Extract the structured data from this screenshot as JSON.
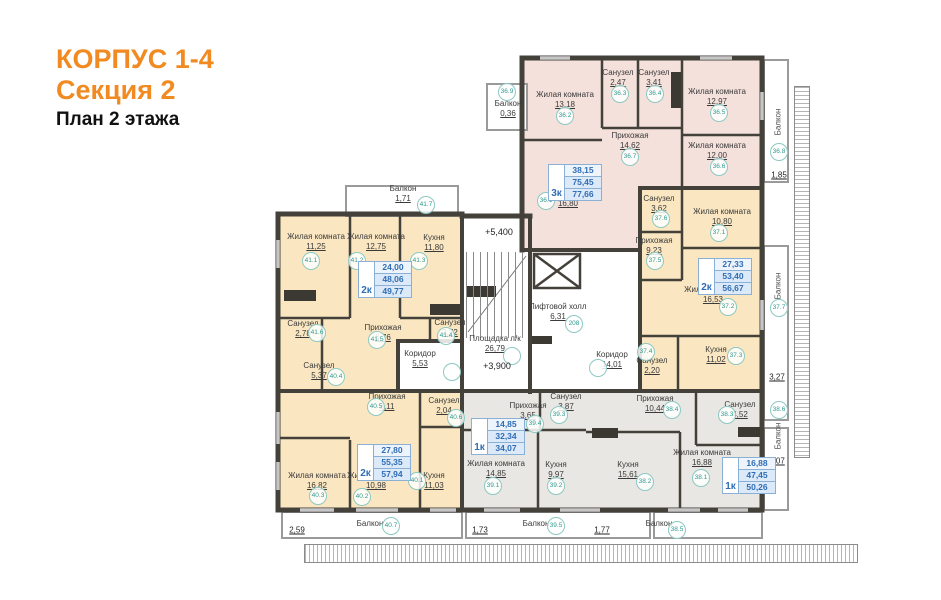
{
  "title": {
    "building": "КОРПУС 1-4",
    "section": "Секция 2",
    "plan": "План 2 этажа"
  },
  "colors": {
    "accent": "#f08a21",
    "apartment_pink": "#f5e1dc",
    "apartment_yellow": "#fae7c1",
    "apartment_gray": "#e9e7e3",
    "wall": "#44403a",
    "circle_teal": "#2e9a90",
    "value_blue": "#2f6db5"
  },
  "apartments": [
    {
      "type": "3к",
      "values": [
        "38,15",
        "75,45",
        "77,66"
      ],
      "x": 548,
      "y": 164
    },
    {
      "type": "2к",
      "values": [
        "27,33",
        "53,40",
        "56,67"
      ],
      "x": 698,
      "y": 258
    },
    {
      "type": "1к",
      "values": [
        "16,88",
        "47,45",
        "50,26"
      ],
      "x": 722,
      "y": 457
    },
    {
      "type": "1к",
      "values": [
        "14,85",
        "32,34",
        "34,07"
      ],
      "x": 471,
      "y": 418
    },
    {
      "type": "2к",
      "values": [
        "24,00",
        "48,06",
        "49,77"
      ],
      "x": 358,
      "y": 261
    },
    {
      "type": "2к",
      "values": [
        "27,80",
        "55,35",
        "57,94"
      ],
      "x": 357,
      "y": 444
    }
  ],
  "rooms": [
    {
      "name": "Жилая комната",
      "area": "13,18",
      "x": 565,
      "y": 90
    },
    {
      "name": "Санузел",
      "area": "2,47",
      "x": 618,
      "y": 68
    },
    {
      "name": "Санузел",
      "area": "3,41",
      "x": 654,
      "y": 68
    },
    {
      "name": "Жилая комната",
      "area": "12,97",
      "x": 717,
      "y": 87
    },
    {
      "name": "Прихожая",
      "area": "14,62",
      "x": 630,
      "y": 131
    },
    {
      "name": "Жилая комната",
      "area": "12,00",
      "x": 717,
      "y": 141
    },
    {
      "name": "Кухня",
      "area": "16,80",
      "x": 568,
      "y": 189
    },
    {
      "name": "Балкон",
      "area": "0,36",
      "x": 508,
      "y": 99
    },
    {
      "name": "Санузел",
      "area": "3,62",
      "x": 659,
      "y": 194
    },
    {
      "name": "Жилая комната",
      "area": "10,80",
      "x": 722,
      "y": 207
    },
    {
      "name": "Прихожая",
      "area": "9,23",
      "x": 654,
      "y": 236
    },
    {
      "name": "Жилая комната",
      "area": "16,53",
      "x": 713,
      "y": 285
    },
    {
      "name": "Кухня",
      "area": "11,02",
      "x": 716,
      "y": 345
    },
    {
      "name": "Санузел",
      "area": "2,20",
      "x": 652,
      "y": 356
    },
    {
      "name": "Прихожая",
      "area": "10,44",
      "x": 655,
      "y": 394
    },
    {
      "name": "Санузел",
      "area": "4,52",
      "x": 740,
      "y": 400
    },
    {
      "name": "Жилая комната",
      "area": "16,88",
      "x": 702,
      "y": 448
    },
    {
      "name": "Кухня",
      "area": "15,61",
      "x": 628,
      "y": 460
    },
    {
      "name": "Прихожая",
      "area": "3,65",
      "x": 528,
      "y": 401
    },
    {
      "name": "Санузел",
      "area": "3,87",
      "x": 566,
      "y": 392
    },
    {
      "name": "Жилая комната",
      "area": "14,85",
      "x": 496,
      "y": 459
    },
    {
      "name": "Кухня",
      "area": "9,97",
      "x": 556,
      "y": 460
    },
    {
      "name": "Жилая комната",
      "area": "11,25",
      "x": 316,
      "y": 232
    },
    {
      "name": "Жилая комната",
      "area": "12,75",
      "x": 376,
      "y": 232
    },
    {
      "name": "Кухня",
      "area": "11,80",
      "x": 434,
      "y": 233
    },
    {
      "name": "Санузел",
      "area": "2,78",
      "x": 303,
      "y": 319
    },
    {
      "name": "Прихожая",
      "area": "6,76",
      "x": 383,
      "y": 323
    },
    {
      "name": "Санузел",
      "area": "2,72",
      "x": 450,
      "y": 318
    },
    {
      "name": "Санузел",
      "area": "5,37",
      "x": 319,
      "y": 361
    },
    {
      "name": "Коридор",
      "area": "5,53",
      "x": 420,
      "y": 349
    },
    {
      "name": "Прихожая",
      "area": "9,11",
      "x": 387,
      "y": 392
    },
    {
      "name": "Санузел",
      "area": "2,04",
      "x": 444,
      "y": 396
    },
    {
      "name": "Жилая комната",
      "area": "16,82",
      "x": 317,
      "y": 471
    },
    {
      "name": "Жилая комната",
      "area": "10,98",
      "x": 376,
      "y": 471
    },
    {
      "name": "Кухня",
      "area": "11,03",
      "x": 434,
      "y": 471
    },
    {
      "name": "Площадка л/к",
      "area": "26,79",
      "x": 495,
      "y": 334
    },
    {
      "name": "Лифтовой холл",
      "area": "6,31",
      "x": 558,
      "y": 302
    },
    {
      "name": "Коридор",
      "area": "14,01",
      "x": 612,
      "y": 350
    },
    {
      "name": "Балкон",
      "area": "1,71",
      "x": 403,
      "y": 184
    },
    {
      "name": "Балкон",
      "area": "",
      "x": 370,
      "y": 519
    },
    {
      "name": "Балкон",
      "area": "",
      "x": 536,
      "y": 519
    },
    {
      "name": "Балкон",
      "area": "",
      "x": 659,
      "y": 519
    }
  ],
  "circles": [
    {
      "t": "36.1",
      "x": 546,
      "y": 201
    },
    {
      "t": "36.2",
      "x": 565,
      "y": 116
    },
    {
      "t": "36.3",
      "x": 620,
      "y": 94
    },
    {
      "t": "36.4",
      "x": 655,
      "y": 94
    },
    {
      "t": "36.5",
      "x": 719,
      "y": 113
    },
    {
      "t": "36.6",
      "x": 719,
      "y": 167
    },
    {
      "t": "36.7",
      "x": 630,
      "y": 157
    },
    {
      "t": "36.8",
      "x": 779,
      "y": 152
    },
    {
      "t": "36.9",
      "x": 507,
      "y": 92
    },
    {
      "t": "37.1",
      "x": 719,
      "y": 233
    },
    {
      "t": "37.2",
      "x": 728,
      "y": 307
    },
    {
      "t": "37.3",
      "x": 736,
      "y": 356
    },
    {
      "t": "37.4",
      "x": 646,
      "y": 352
    },
    {
      "t": "37.5",
      "x": 655,
      "y": 261
    },
    {
      "t": "37.6",
      "x": 661,
      "y": 219
    },
    {
      "t": "37.7",
      "x": 779,
      "y": 308
    },
    {
      "t": "38.1",
      "x": 701,
      "y": 478
    },
    {
      "t": "38.2",
      "x": 645,
      "y": 482
    },
    {
      "t": "38.3",
      "x": 727,
      "y": 415
    },
    {
      "t": "38.4",
      "x": 672,
      "y": 410
    },
    {
      "t": "38.5",
      "x": 677,
      "y": 530
    },
    {
      "t": "38.6",
      "x": 779,
      "y": 410
    },
    {
      "t": "39.1",
      "x": 493,
      "y": 486
    },
    {
      "t": "39.2",
      "x": 556,
      "y": 486
    },
    {
      "t": "39.3",
      "x": 559,
      "y": 415
    },
    {
      "t": "39.4",
      "x": 535,
      "y": 424
    },
    {
      "t": "39.5",
      "x": 556,
      "y": 526
    },
    {
      "t": "40.1",
      "x": 417,
      "y": 481
    },
    {
      "t": "40.2",
      "x": 362,
      "y": 497
    },
    {
      "t": "40.3",
      "x": 318,
      "y": 496
    },
    {
      "t": "40.4",
      "x": 336,
      "y": 377
    },
    {
      "t": "40.5",
      "x": 376,
      "y": 407
    },
    {
      "t": "40.6",
      "x": 456,
      "y": 418
    },
    {
      "t": "40.7",
      "x": 391,
      "y": 526
    },
    {
      "t": "41.1",
      "x": 311,
      "y": 261
    },
    {
      "t": "41.2",
      "x": 357,
      "y": 261
    },
    {
      "t": "41.3",
      "x": 419,
      "y": 261
    },
    {
      "t": "41.4",
      "x": 446,
      "y": 336
    },
    {
      "t": "41.5",
      "x": 377,
      "y": 340
    },
    {
      "t": "41.6",
      "x": 317,
      "y": 333
    },
    {
      "t": "41.7",
      "x": 426,
      "y": 205
    },
    {
      "t": "208",
      "x": 574,
      "y": 324
    },
    {
      "t": "",
      "x": 452,
      "y": 372
    },
    {
      "t": "",
      "x": 598,
      "y": 368
    },
    {
      "t": "",
      "x": 512,
      "y": 356
    }
  ],
  "dimensions": [
    {
      "t": "2,59",
      "x": 297,
      "y": 530
    },
    {
      "t": "1,73",
      "x": 480,
      "y": 530
    },
    {
      "t": "1,77",
      "x": 602,
      "y": 530
    },
    {
      "t": "1,85",
      "x": 779,
      "y": 175
    },
    {
      "t": "3,27",
      "x": 777,
      "y": 377
    },
    {
      "t": "1,07",
      "x": 777,
      "y": 461
    }
  ],
  "levels": [
    {
      "t": "+5,400",
      "x": 499,
      "y": 232
    },
    {
      "t": "+3,900",
      "x": 497,
      "y": 366
    }
  ],
  "vertical_labels": [
    {
      "t": "Балкон",
      "x": 778,
      "y": 122
    },
    {
      "t": "Балкон",
      "x": 778,
      "y": 286
    },
    {
      "t": "Балкон",
      "x": 778,
      "y": 436
    }
  ]
}
